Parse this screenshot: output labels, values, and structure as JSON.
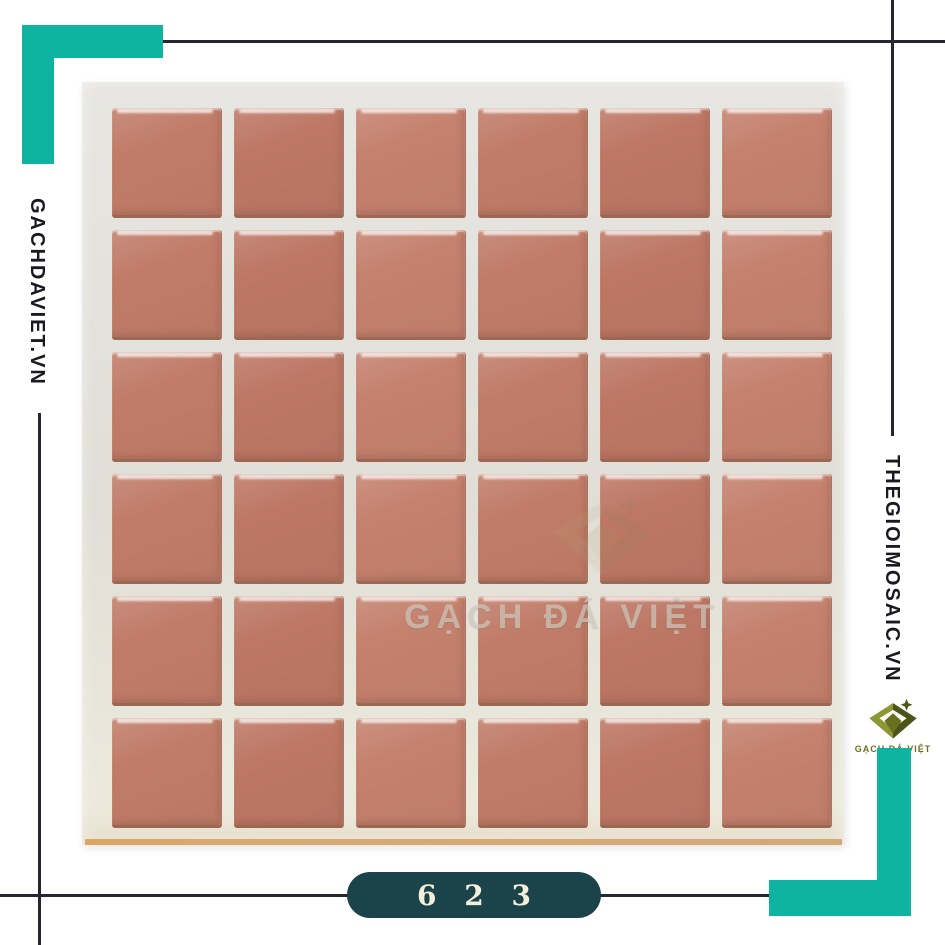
{
  "brand": {
    "left_site": "GACHDAVIET.VN",
    "right_site": "THEGIOIMOSAIC.VN",
    "logo_caption": "GẠCH ĐÁ VIỆT"
  },
  "watermark": {
    "text": "GẠCH ĐÁ VIỆT"
  },
  "badge": {
    "code": "6 2 3"
  },
  "sheet": {
    "rows": 6,
    "cols": 6,
    "description": "terracotta ceramic mosaic tile sheet"
  },
  "colors": {
    "accent_teal": "#0eb4a0",
    "line": "#26262e",
    "site_text": "#191922",
    "badge_bg": "#1a4449",
    "badge_text": "#f4eedb",
    "tile": "#c07c68",
    "board": "#e2dfd8",
    "logo_olive": "#67701f"
  }
}
